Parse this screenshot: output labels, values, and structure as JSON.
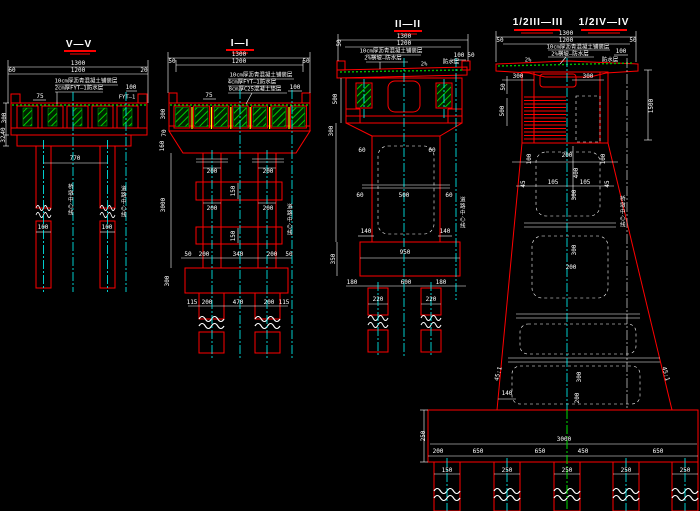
{
  "palette": {
    "background": "#000000",
    "line_red": "#ff0000",
    "dim_white": "#ffffff",
    "centerline_cyan": "#00ffff",
    "hatch_green": "#00e000",
    "tendon_yellow": "#ffff00"
  },
  "views": [
    {
      "id": "section-V-V",
      "title": "V—V",
      "labels": [
        {
          "t": "V—V",
          "x": 79,
          "y": 45,
          "c": "title"
        },
        {
          "t": "1300",
          "x": 78,
          "y": 64
        },
        {
          "t": "1200",
          "x": 78,
          "y": 71
        },
        {
          "t": "60",
          "x": 12,
          "y": 71
        },
        {
          "t": "20",
          "x": 144,
          "y": 71
        },
        {
          "t": "10cm厚沥青混凝土铺装层",
          "x": 86,
          "y": 82,
          "c": "ann"
        },
        {
          "t": "2cm厚FYT—1防水层",
          "x": 79,
          "y": 89,
          "c": "ann"
        },
        {
          "t": "100",
          "x": 131,
          "y": 88
        },
        {
          "t": "FYT—1",
          "x": 127,
          "y": 98,
          "c": "ann"
        },
        {
          "t": "75",
          "x": 40,
          "y": 97
        },
        {
          "t": "300",
          "x": 5,
          "y": 118,
          "r": -90
        },
        {
          "t": "40",
          "x": 4,
          "y": 131,
          "r": -90
        },
        {
          "t": "32",
          "x": 4,
          "y": 139,
          "r": -90
        },
        {
          "t": "770",
          "x": 75,
          "y": 159
        },
        {
          "t": "100",
          "x": 43,
          "y": 228
        },
        {
          "t": "100",
          "x": 107,
          "y": 228
        },
        {
          "t": "桥墩中心线",
          "x": 69,
          "y": 200,
          "c": "vtext"
        },
        {
          "t": "道路中心线",
          "x": 122,
          "y": 202,
          "c": "vtext"
        }
      ]
    },
    {
      "id": "section-I-I",
      "title": "I—I",
      "labels": [
        {
          "t": "I—I",
          "x": 240,
          "y": 44,
          "c": "title"
        },
        {
          "t": "1300",
          "x": 239,
          "y": 55
        },
        {
          "t": "1200",
          "x": 239,
          "y": 62
        },
        {
          "t": "50",
          "x": 172,
          "y": 62
        },
        {
          "t": "50",
          "x": 306,
          "y": 62
        },
        {
          "t": "10cm厚沥青混凝土铺装层",
          "x": 261,
          "y": 76,
          "c": "ann"
        },
        {
          "t": "4cm厚FYT—1防水层",
          "x": 252,
          "y": 83,
          "c": "ann"
        },
        {
          "t": "8cm厚C25混凝土垫层",
          "x": 255,
          "y": 90,
          "c": "ann"
        },
        {
          "t": "100",
          "x": 295,
          "y": 88
        },
        {
          "t": "75",
          "x": 209,
          "y": 96
        },
        {
          "t": "300",
          "x": 164,
          "y": 114,
          "r": -90
        },
        {
          "t": "70",
          "x": 165,
          "y": 133,
          "r": -90
        },
        {
          "t": "160",
          "x": 163,
          "y": 146,
          "r": -90
        },
        {
          "t": "200",
          "x": 212,
          "y": 172
        },
        {
          "t": "200",
          "x": 268,
          "y": 172
        },
        {
          "t": "150",
          "x": 234,
          "y": 191,
          "r": -90
        },
        {
          "t": "200",
          "x": 212,
          "y": 209
        },
        {
          "t": "200",
          "x": 268,
          "y": 209
        },
        {
          "t": "150",
          "x": 234,
          "y": 236,
          "r": -90
        },
        {
          "t": "3000",
          "x": 164,
          "y": 205,
          "r": -90
        },
        {
          "t": "50",
          "x": 188,
          "y": 255
        },
        {
          "t": "200",
          "x": 204,
          "y": 255
        },
        {
          "t": "340",
          "x": 238,
          "y": 255
        },
        {
          "t": "200",
          "x": 272,
          "y": 255
        },
        {
          "t": "50",
          "x": 289,
          "y": 255
        },
        {
          "t": "300",
          "x": 168,
          "y": 281,
          "r": -90
        },
        {
          "t": "115",
          "x": 192,
          "y": 303
        },
        {
          "t": "200",
          "x": 207,
          "y": 303
        },
        {
          "t": "470",
          "x": 238,
          "y": 303
        },
        {
          "t": "200",
          "x": 269,
          "y": 303
        },
        {
          "t": "115",
          "x": 284,
          "y": 303
        },
        {
          "t": "道路中心线",
          "x": 288,
          "y": 220,
          "c": "vtext"
        }
      ]
    },
    {
      "id": "section-II-II",
      "title": "II—II",
      "labels": [
        {
          "t": "II—II",
          "x": 408,
          "y": 25,
          "c": "title"
        },
        {
          "t": "1300",
          "x": 404,
          "y": 37
        },
        {
          "t": "1200",
          "x": 404,
          "y": 44
        },
        {
          "t": "50",
          "x": 340,
          "y": 43,
          "r": -90
        },
        {
          "t": "100",
          "x": 459,
          "y": 56
        },
        {
          "t": "50",
          "x": 471,
          "y": 56
        },
        {
          "t": "10cm厚沥青混凝土铺装层",
          "x": 391,
          "y": 52,
          "c": "ann"
        },
        {
          "t": "2%横坡—防水层",
          "x": 383,
          "y": 59,
          "c": "ann"
        },
        {
          "t": "2%",
          "x": 424,
          "y": 65,
          "c": "ann"
        },
        {
          "t": "防水层",
          "x": 451,
          "y": 63,
          "c": "ann"
        },
        {
          "t": "500",
          "x": 336,
          "y": 99,
          "r": -90
        },
        {
          "t": "300",
          "x": 332,
          "y": 131,
          "r": -90
        },
        {
          "t": "60",
          "x": 362,
          "y": 151
        },
        {
          "t": "60",
          "x": 432,
          "y": 151
        },
        {
          "t": "60",
          "x": 360,
          "y": 196
        },
        {
          "t": "500",
          "x": 404,
          "y": 196
        },
        {
          "t": "60",
          "x": 449,
          "y": 196
        },
        {
          "t": "140",
          "x": 366,
          "y": 232
        },
        {
          "t": "140",
          "x": 445,
          "y": 232
        },
        {
          "t": "950",
          "x": 405,
          "y": 253
        },
        {
          "t": "350",
          "x": 334,
          "y": 259,
          "r": -90
        },
        {
          "t": "180",
          "x": 352,
          "y": 283
        },
        {
          "t": "600",
          "x": 406,
          "y": 283
        },
        {
          "t": "180",
          "x": 441,
          "y": 283
        },
        {
          "t": "220",
          "x": 378,
          "y": 300
        },
        {
          "t": "220",
          "x": 431,
          "y": 300
        },
        {
          "t": "道路中心线",
          "x": 461,
          "y": 213,
          "c": "vtext"
        }
      ]
    },
    {
      "id": "section-half-III-III-IV-IV",
      "title": "1/2III—III",
      "title2": "1/2IV—IV",
      "labels": [
        {
          "t": "1/2III—III",
          "x": 538,
          "y": 23,
          "c": "title"
        },
        {
          "t": "1/2IV—IV",
          "x": 604,
          "y": 23,
          "c": "title"
        },
        {
          "t": "1300",
          "x": 566,
          "y": 34
        },
        {
          "t": "1200",
          "x": 566,
          "y": 41
        },
        {
          "t": "50",
          "x": 500,
          "y": 41
        },
        {
          "t": "50",
          "x": 633,
          "y": 41
        },
        {
          "t": "10cm厚沥青混凝土铺装层",
          "x": 578,
          "y": 48,
          "c": "ann"
        },
        {
          "t": "2%横坡—防水层",
          "x": 570,
          "y": 55,
          "c": "ann"
        },
        {
          "t": "100",
          "x": 621,
          "y": 52
        },
        {
          "t": "防水层",
          "x": 610,
          "y": 61,
          "c": "ann"
        },
        {
          "t": "2%",
          "x": 528,
          "y": 61,
          "c": "ann"
        },
        {
          "t": "300",
          "x": 518,
          "y": 77
        },
        {
          "t": "300",
          "x": 588,
          "y": 77
        },
        {
          "t": "50",
          "x": 504,
          "y": 87,
          "r": -90
        },
        {
          "t": "500",
          "x": 503,
          "y": 111,
          "r": -90
        },
        {
          "t": "1500",
          "x": 652,
          "y": 106,
          "r": -90
        },
        {
          "t": "100",
          "x": 530,
          "y": 159,
          "r": -90
        },
        {
          "t": "200",
          "x": 567,
          "y": 156
        },
        {
          "t": "100",
          "x": 604,
          "y": 159,
          "r": -90
        },
        {
          "t": "400",
          "x": 577,
          "y": 173,
          "r": -90
        },
        {
          "t": "45",
          "x": 524,
          "y": 184,
          "r": -90
        },
        {
          "t": "105",
          "x": 553,
          "y": 183
        },
        {
          "t": "105",
          "x": 585,
          "y": 183
        },
        {
          "t": "45",
          "x": 608,
          "y": 184,
          "r": -90
        },
        {
          "t": "300",
          "x": 575,
          "y": 195,
          "r": -90
        },
        {
          "t": "300",
          "x": 575,
          "y": 250,
          "r": -90
        },
        {
          "t": "200",
          "x": 571,
          "y": 268
        },
        {
          "t": "45:1",
          "x": 499,
          "y": 374,
          "r": -75
        },
        {
          "t": "45:1",
          "x": 665,
          "y": 374,
          "r": 75
        },
        {
          "t": "300",
          "x": 580,
          "y": 377,
          "r": -90
        },
        {
          "t": "140",
          "x": 507,
          "y": 394
        },
        {
          "t": "200",
          "x": 578,
          "y": 398,
          "r": -90
        },
        {
          "t": "250",
          "x": 424,
          "y": 436,
          "r": -90
        },
        {
          "t": "3000",
          "x": 564,
          "y": 440
        },
        {
          "t": "200",
          "x": 438,
          "y": 452
        },
        {
          "t": "650",
          "x": 478,
          "y": 452
        },
        {
          "t": "650",
          "x": 540,
          "y": 452
        },
        {
          "t": "450",
          "x": 583,
          "y": 452
        },
        {
          "t": "650",
          "x": 658,
          "y": 452
        },
        {
          "t": "150",
          "x": 447,
          "y": 471
        },
        {
          "t": "250",
          "x": 507,
          "y": 471
        },
        {
          "t": "250",
          "x": 567,
          "y": 471
        },
        {
          "t": "250",
          "x": 626,
          "y": 471
        },
        {
          "t": "250",
          "x": 685,
          "y": 471
        },
        {
          "t": "桥墩中心线",
          "x": 621,
          "y": 212,
          "c": "vtext"
        }
      ]
    }
  ]
}
